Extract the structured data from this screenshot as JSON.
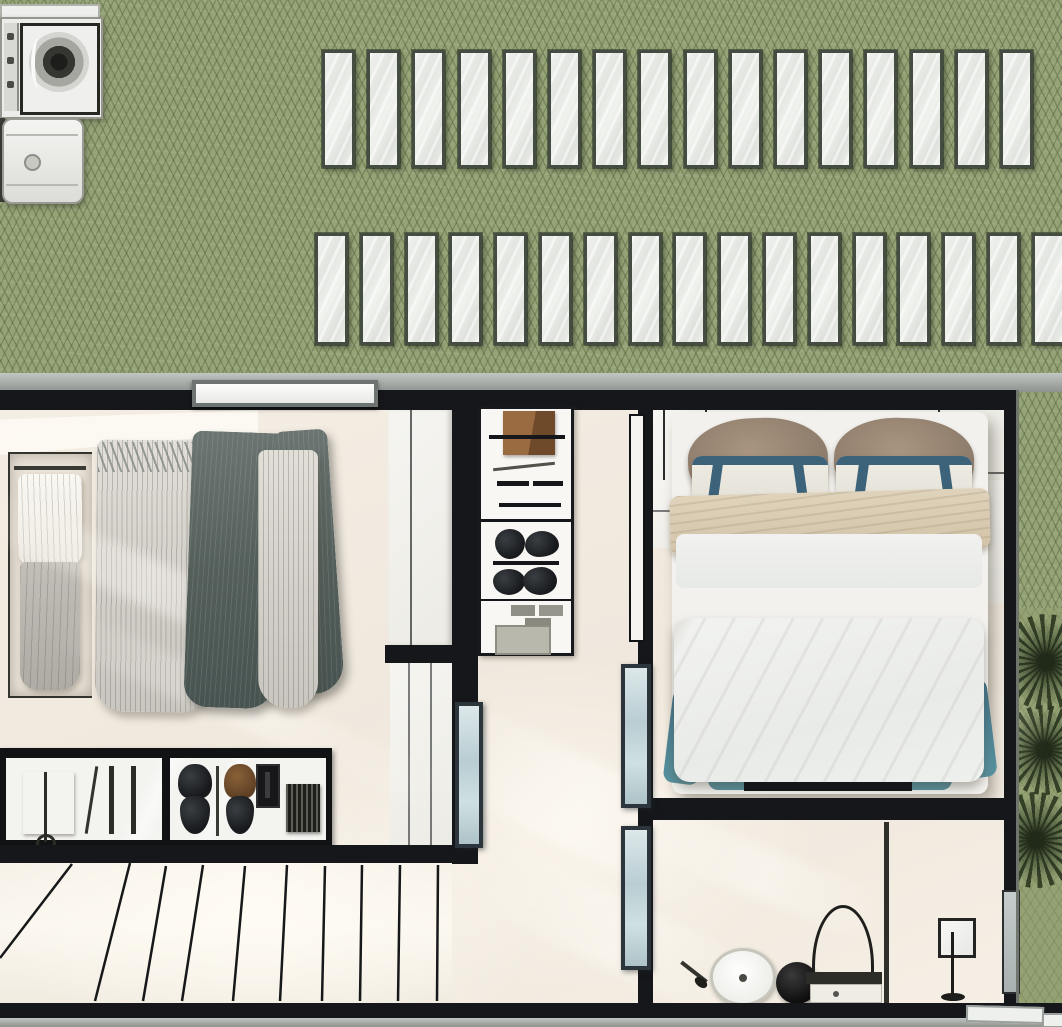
{
  "scene": {
    "kind": "architectural floor plan, photorealistic top-down render",
    "width": 1062,
    "height": 1027,
    "rooms": [
      "walk-in-closet",
      "hallway",
      "bedroom",
      "bathroom-vanity",
      "roof-terrace"
    ]
  },
  "palette": {
    "roof_green": "#95a376",
    "roof_hatch": "#4a5834",
    "slat_fill": "#eceeea",
    "slat_border": "#454d43",
    "wall_black": "#15171a",
    "band_gray": "#a8aca9",
    "floor_cream": "#f3ece2",
    "glass_blue": "#bccfd3",
    "bed_teal": "#4a7e96",
    "pillow_taupe": "#9b8877",
    "throw_beige": "#d9cbb2",
    "leather_brown": "#8a6343",
    "palm_green": "#2c3820"
  },
  "roof": {
    "skylight_rows": [
      {
        "x": 322,
        "y": 50,
        "count": 16,
        "pitch": 45.2,
        "slat_w": 27,
        "slat_h": 112
      },
      {
        "x": 315,
        "y": 233,
        "count": 17,
        "pitch": 44.8,
        "slat_w": 27,
        "slat_h": 106
      }
    ]
  },
  "appliances": {
    "washer": "top-load washing machine",
    "dryer": "compact dryer"
  },
  "stairs": {
    "area": {
      "x": 0,
      "y": 863,
      "w": 452,
      "h": 140
    },
    "tread_lines": [
      [
        72,
        1,
        0,
        95
      ],
      [
        130,
        0,
        95,
        138
      ],
      [
        166,
        3,
        143,
        138
      ],
      [
        203,
        2,
        182,
        138
      ],
      [
        245,
        3,
        233,
        138
      ],
      [
        287,
        2,
        280,
        138
      ],
      [
        325,
        3,
        322,
        138
      ],
      [
        362,
        2,
        360,
        138
      ],
      [
        400,
        2,
        398,
        138
      ],
      [
        438,
        2,
        437,
        138
      ]
    ]
  },
  "palms": {
    "strip": {
      "x": 1018,
      "y": 608,
      "w": 44,
      "h": 397
    },
    "canopies": [
      {
        "cx": 1046,
        "cy": 662,
        "r": 48
      },
      {
        "cx": 1044,
        "cy": 750,
        "r": 45
      },
      {
        "cx": 1036,
        "cy": 840,
        "r": 48
      }
    ]
  },
  "sunlight": {
    "streaks": [
      {
        "x": -40,
        "y": 560,
        "w": 380,
        "h": 46,
        "rot": 24,
        "op": 0.5
      },
      {
        "x": 40,
        "y": 690,
        "w": 420,
        "h": 40,
        "rot": 24,
        "op": 0.45
      },
      {
        "x": 430,
        "y": 760,
        "w": 300,
        "h": 90,
        "rot": 26,
        "op": 0.6
      },
      {
        "x": 470,
        "y": 900,
        "w": 300,
        "h": 70,
        "rot": 26,
        "op": 0.5
      },
      {
        "x": 640,
        "y": 640,
        "w": 420,
        "h": 60,
        "rot": 22,
        "op": 0.5
      },
      {
        "x": 700,
        "y": 480,
        "w": 280,
        "h": 40,
        "rot": 22,
        "op": 0.4
      },
      {
        "x": 636,
        "y": 850,
        "w": 260,
        "h": 50,
        "rot": 22,
        "op": 0.5
      }
    ]
  },
  "closet": {
    "objects": [
      "garment niche",
      "hanging rail with pleated and dark garments",
      "double-door wardrobe",
      "glass accessory display case",
      "winder staircase"
    ],
    "case_items": [
      "leather folio",
      "pen",
      "two rods",
      "black bow tie",
      "brown bow tie",
      "wallet",
      "striped card case"
    ]
  },
  "hallway": {
    "objects": [
      "open shelf unit",
      "three glass pivot door leaves",
      "white door leaf"
    ]
  },
  "bedroom": {
    "objects": [
      "double bed",
      "two taupe pillows",
      "two strapped white pillows",
      "beige throw",
      "teal runner",
      "white duvet",
      "footboard bench"
    ]
  },
  "bathroom": {
    "objects": [
      "grooming set",
      "oval sink",
      "black stool sphere",
      "arch mirror",
      "vanity desk",
      "square-head floor lamp",
      "glass wall panel"
    ]
  }
}
